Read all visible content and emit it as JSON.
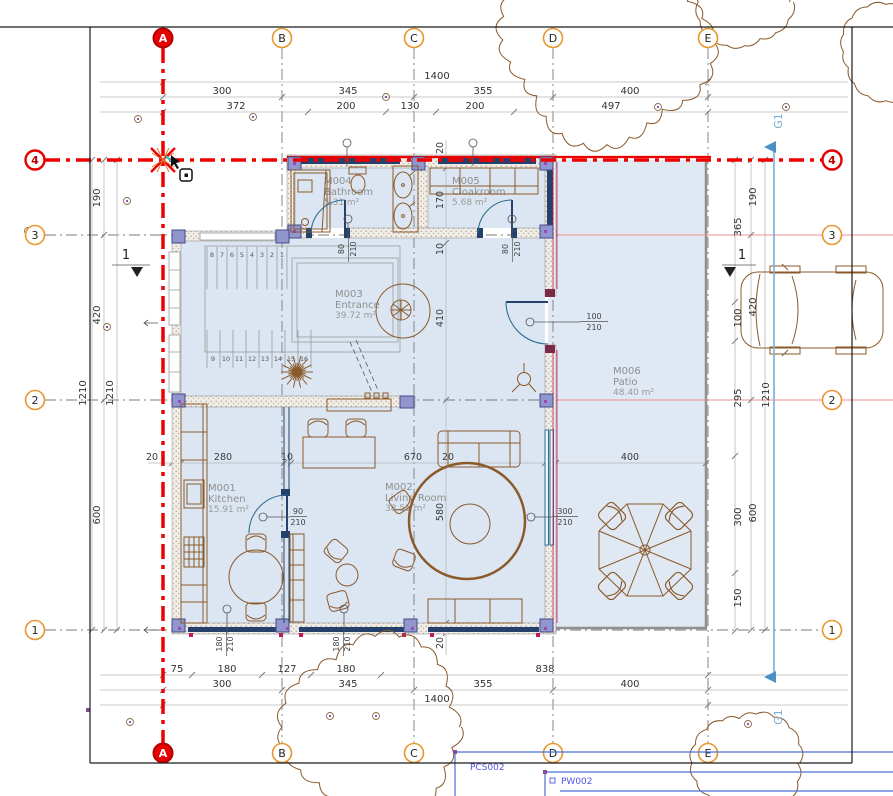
{
  "grid": {
    "cols": [
      "A",
      "B",
      "C",
      "D",
      "E"
    ],
    "rows": [
      "4",
      "3",
      "2",
      "1"
    ]
  },
  "rooms": {
    "kitchen": {
      "id": "M001",
      "name": "Kitchen",
      "area": "15.91 m²"
    },
    "living": {
      "id": "M002",
      "name": "Living Room",
      "area": "38.51 m²"
    },
    "entrance": {
      "id": "M003",
      "name": "Entrance",
      "area": "39.72 m²"
    },
    "bathroom": {
      "id": "M004",
      "name": "Bathroom",
      "area": "5.31 m²"
    },
    "cloakroom": {
      "id": "M005",
      "name": "Cloakroom",
      "area": "5.68 m²"
    },
    "patio": {
      "id": "M006",
      "name": "Patio",
      "area": "48.40 m²"
    }
  },
  "dims": {
    "top": {
      "total": "1400",
      "segments": [
        "300",
        "345",
        "355",
        "400"
      ],
      "sub": [
        "372",
        "200",
        "130",
        "200",
        "497"
      ]
    },
    "bottom": {
      "sub": [
        "75",
        "180",
        "127",
        "180",
        "838"
      ],
      "segments": [
        "300",
        "345",
        "355",
        "400"
      ],
      "total": "1400"
    },
    "left": {
      "segments": [
        "190",
        "420",
        "600"
      ],
      "totals": [
        "1210",
        "1210"
      ]
    },
    "right": {
      "offsets": [
        "365",
        "100",
        "295",
        "300",
        "150"
      ],
      "segments": [
        "190",
        "420",
        "600"
      ],
      "total": "1210"
    },
    "interior_h": [
      "20",
      "280",
      "10",
      "670",
      "20",
      "400"
    ],
    "interior_v": [
      "20",
      "170",
      "10",
      "410",
      "580",
      "20"
    ]
  },
  "openings": {
    "bath_door": {
      "w": "80",
      "h": "210"
    },
    "cloak_door": {
      "w": "80",
      "h": "210"
    },
    "kitchen_door": {
      "w": "90",
      "h": "210"
    },
    "patio_door": {
      "w": "100",
      "h": "210"
    },
    "living_window": {
      "w": "300",
      "h": "210"
    },
    "south_window_a": {
      "w": "180",
      "h": "210"
    },
    "south_window_b": {
      "w": "180",
      "h": "210"
    }
  },
  "stairs": {
    "up": [
      "8",
      "7",
      "6",
      "5",
      "4",
      "3",
      "2",
      "1"
    ],
    "down": [
      "9",
      "10",
      "11",
      "12",
      "13",
      "14",
      "15",
      "16"
    ]
  },
  "annotations": {
    "grid_ref": "G1",
    "section": "1",
    "pcs": "PCS002",
    "pw": "PW002"
  },
  "colors": {
    "grid_accent": "#ee0000",
    "bubble_ring": "#e8962e",
    "wall_window": "#24416b",
    "furniture": "#8a5a2b",
    "door": "#2e6f92",
    "note_blue": "#5156e8",
    "ref_blue": "#7bafd4"
  }
}
